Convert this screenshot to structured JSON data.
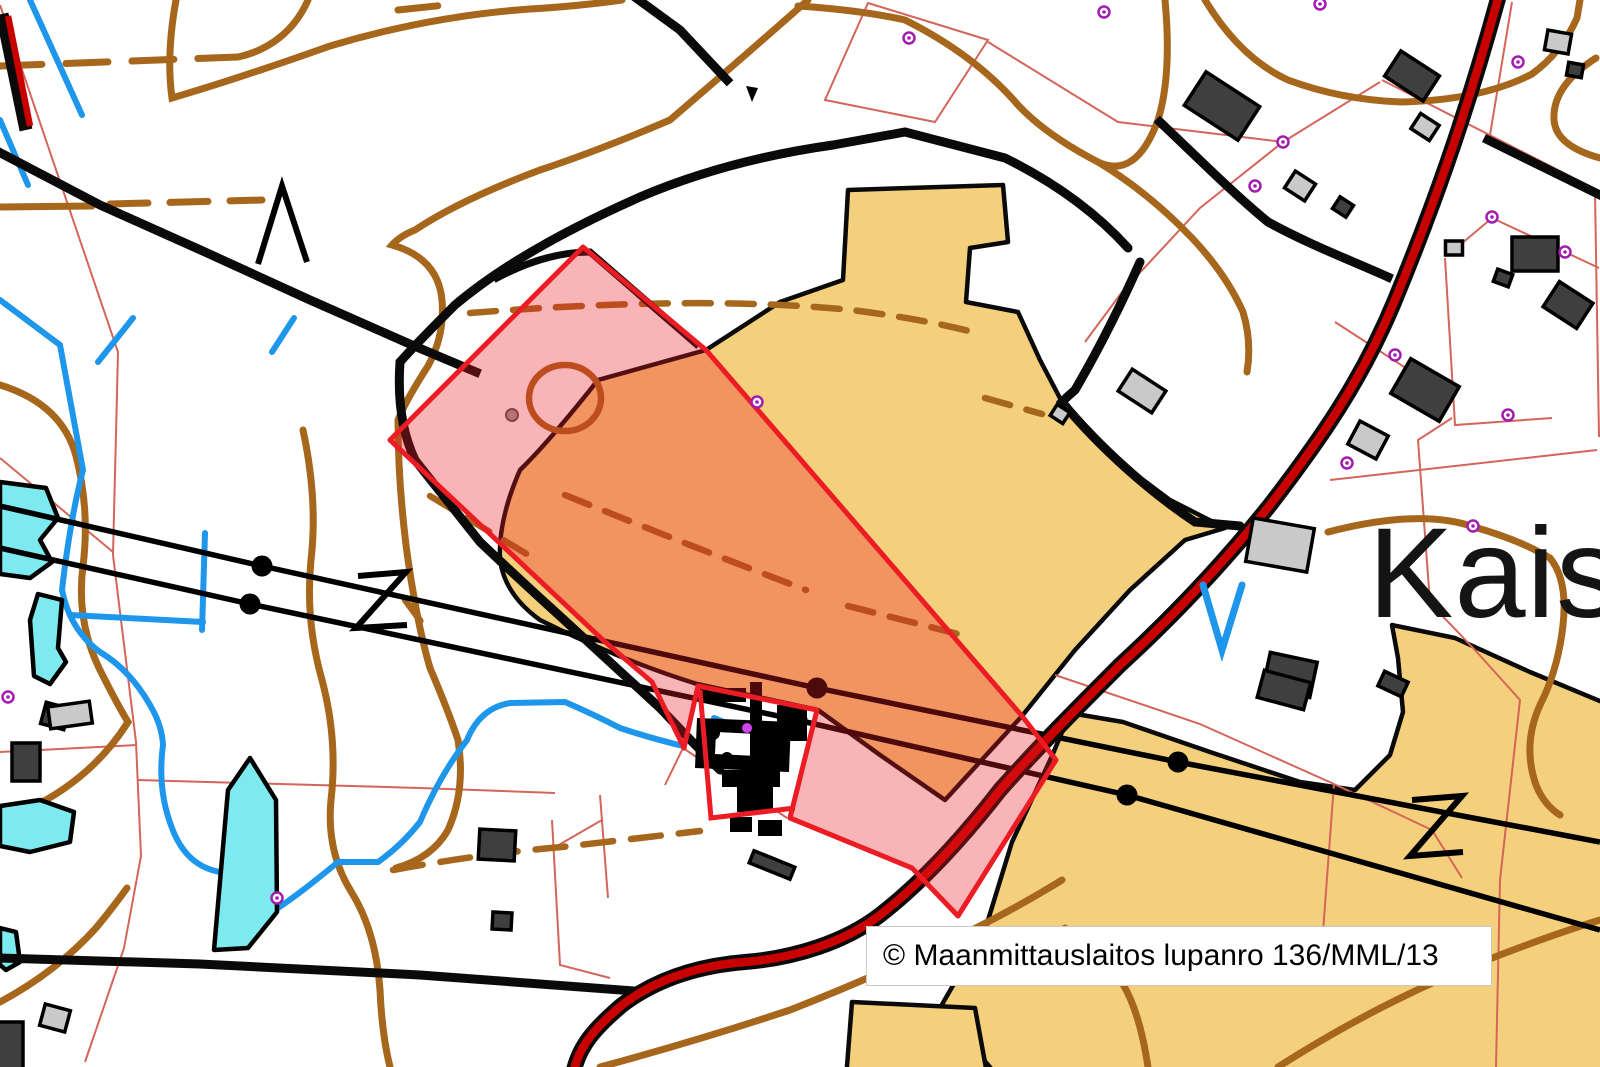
{
  "map": {
    "place_label": "Kais",
    "attribution": "© Maanmittauslaitos lupanro 136/MML/13"
  },
  "colors": {
    "field_yellow": "#F5D07C",
    "overlay_red": "#EB1C23",
    "overlay_fill": "rgba(236,28,35,0.33)",
    "contour_brown": "#A6661B",
    "water_blue": "#1E96EB",
    "pond_cyan": "#7DEAF0",
    "road_red_core": "#C80000",
    "road_black": "#0A0A0A",
    "parcel_line": "#D4655A",
    "building_dark": "#3F3F3F",
    "building_light": "#C9C9C9",
    "boundary_marker": "#A21CAF"
  },
  "markers": {
    "boundary": [
      [
        909,
        38
      ],
      [
        1104,
        12
      ],
      [
        1320,
        4
      ],
      [
        1518,
        62
      ],
      [
        1283,
        142
      ],
      [
        1255,
        186
      ],
      [
        1492,
        217
      ],
      [
        1565,
        252
      ],
      [
        1395,
        355
      ],
      [
        1347,
        463
      ],
      [
        1508,
        415
      ],
      [
        757,
        402
      ],
      [
        1473,
        526
      ],
      [
        277,
        898
      ],
      [
        8,
        697
      ]
    ],
    "pylons": [
      [
        262,
        566
      ],
      [
        250,
        604
      ],
      [
        817,
        688
      ],
      [
        797,
        720
      ],
      [
        1178,
        762
      ],
      [
        1127,
        795
      ]
    ],
    "cairn_gray": [
      512,
      415
    ],
    "cluster_magenta": [
      747,
      728
    ]
  },
  "buildings": {
    "dark": [
      [
        1222,
        106,
        64,
        40,
        33
      ],
      [
        1412,
        76,
        46,
        30,
        33
      ],
      [
        1575,
        70,
        15,
        13,
        10
      ],
      [
        1535,
        254,
        46,
        34,
        0
      ],
      [
        1503,
        278,
        16,
        13,
        20
      ],
      [
        1568,
        305,
        40,
        30,
        33
      ],
      [
        1290,
        675,
        48,
        36,
        12
      ],
      [
        1425,
        390,
        56,
        40,
        30
      ],
      [
        1343,
        207,
        16,
        14,
        33
      ],
      [
        1284,
        690,
        48,
        28,
        15
      ],
      [
        1393,
        684,
        26,
        16,
        25
      ],
      [
        55,
        716,
        24,
        22,
        15
      ],
      [
        26,
        762,
        28,
        38,
        0
      ],
      [
        8,
        1048,
        30,
        52,
        0
      ],
      [
        497,
        845,
        36,
        30,
        3
      ],
      [
        502,
        921,
        19,
        17,
        3
      ],
      [
        772,
        865,
        44,
        13,
        22
      ]
    ],
    "light": [
      [
        1558,
        42,
        24,
        20,
        10
      ],
      [
        1425,
        127,
        22,
        18,
        33
      ],
      [
        1300,
        186,
        24,
        20,
        33
      ],
      [
        1142,
        391,
        40,
        26,
        33
      ],
      [
        1060,
        414,
        15,
        13,
        33
      ],
      [
        1280,
        545,
        62,
        44,
        10
      ],
      [
        1368,
        440,
        32,
        26,
        28
      ],
      [
        1454,
        248,
        17,
        14,
        0
      ],
      [
        70,
        715,
        42,
        22,
        -8
      ],
      [
        55,
        1018,
        26,
        22,
        15
      ]
    ]
  }
}
